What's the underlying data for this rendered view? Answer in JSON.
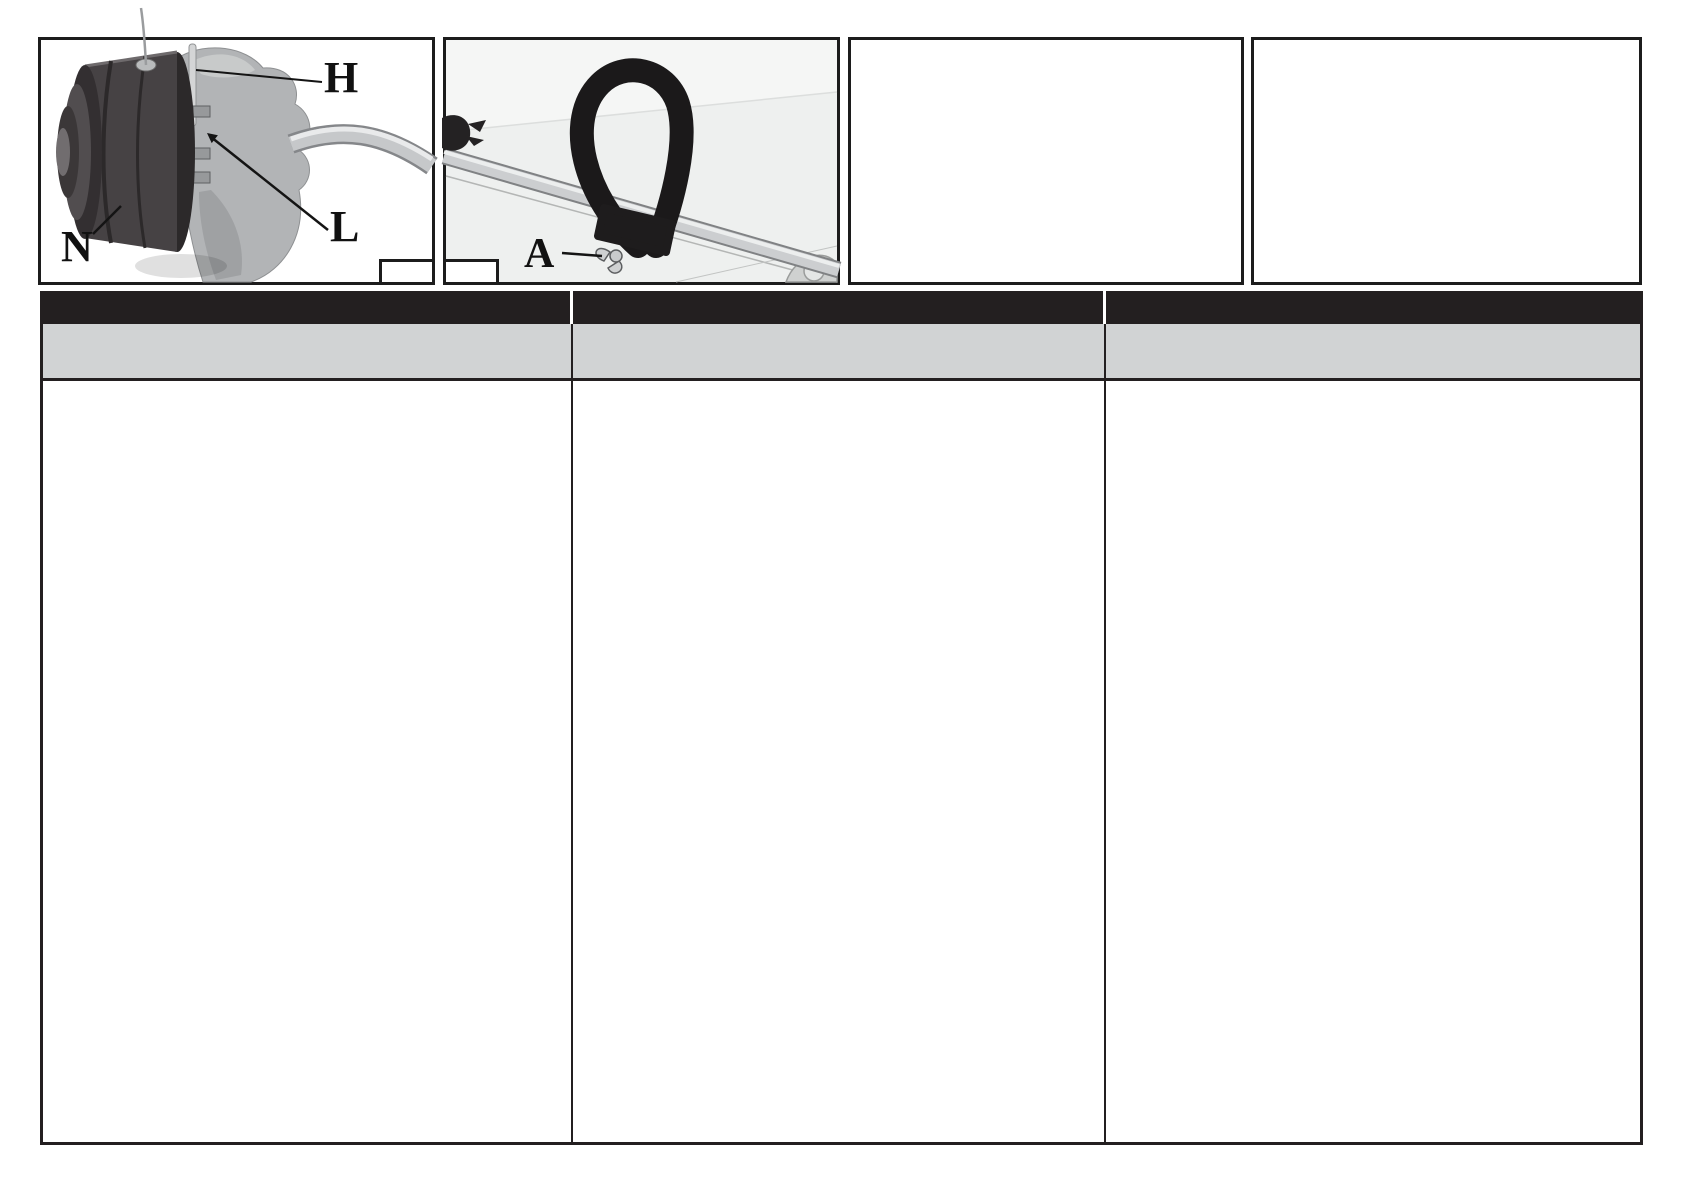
{
  "page": {
    "background": "#ffffff",
    "kind": "manual-figure-page"
  },
  "figures": {
    "fig1": {
      "depicts": "string-trimmer head mounted on gear housing with curved drive tube",
      "label_h": "H",
      "label_l": "L",
      "label_n": "N",
      "number_box": ""
    },
    "fig2": {
      "depicts": "loop handle clamped to drive shaft with wing nut",
      "label_a": "A",
      "number_box": ""
    },
    "fig3": {
      "depicts": ""
    },
    "fig4": {
      "depicts": ""
    }
  },
  "table": {
    "colors": {
      "header_bg": "#231f20",
      "subheader_bg": "#d1d3d4",
      "border": "#231f20"
    },
    "columns": [
      {
        "header": "",
        "subheader": "",
        "body": ""
      },
      {
        "header": "",
        "subheader": "",
        "body": ""
      },
      {
        "header": "",
        "subheader": "",
        "body": ""
      }
    ]
  }
}
